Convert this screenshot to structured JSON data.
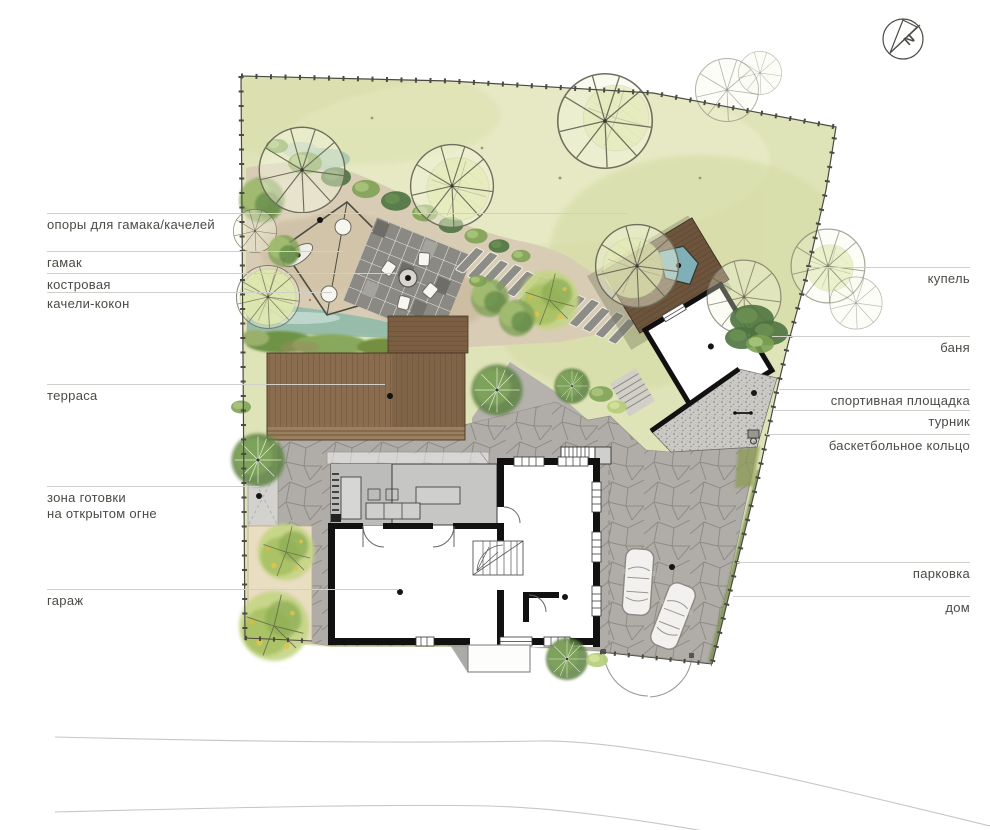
{
  "north": {
    "letter": "N"
  },
  "labels": {
    "left": [
      {
        "text": "опоры для гамака/качелей"
      },
      {
        "text": "гамак"
      },
      {
        "text": "костровая"
      },
      {
        "text": "качели-кокон"
      },
      {
        "text": "терраса"
      },
      {
        "text": "зона готовки",
        "text2": "на открытом огне"
      },
      {
        "text": "гараж"
      }
    ],
    "right": [
      {
        "text": "купель"
      },
      {
        "text": "баня"
      },
      {
        "text": "спортивная площадка"
      },
      {
        "text": "турник"
      },
      {
        "text": "баскетбольное кольцо"
      },
      {
        "text": "парковка"
      },
      {
        "text": "дом"
      }
    ]
  },
  "palette": {
    "lawn": "#dfe3b8",
    "sand": "#d8ccb5",
    "deck_wood": "#7d6045",
    "water": "#8cb8a8",
    "paving": "#b0aca8",
    "gravel": "#cbc9c5",
    "wall": "#111111",
    "tree_green": "#7fa057",
    "tree_lime": "#d4e093",
    "shadow_olive": "#6b7050",
    "label_text": "#4b4a45",
    "leader_line": "#cfcfcb",
    "fence": "#4a4a43"
  }
}
